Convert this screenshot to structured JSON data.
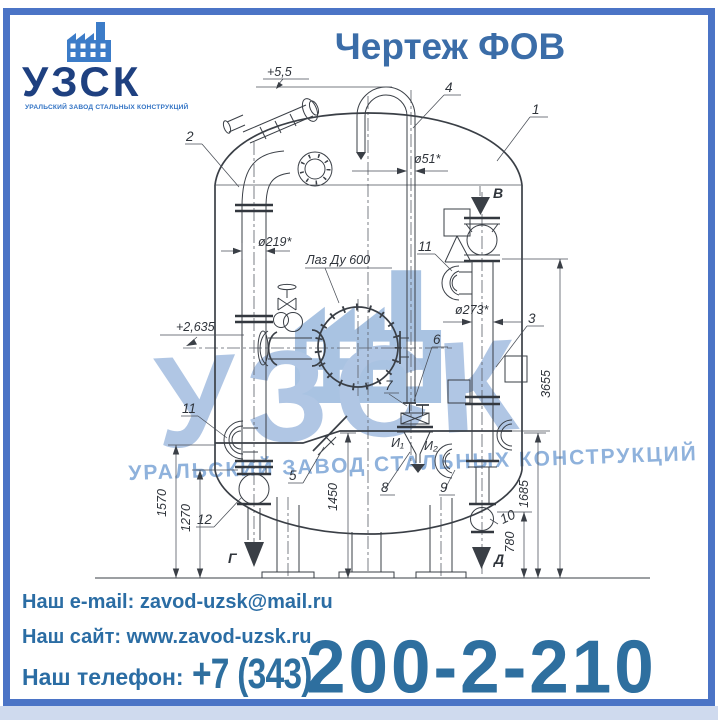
{
  "brand": {
    "name": "УЗСК",
    "tagline": "УРАЛЬСКИЙ ЗАВОД СТАЛЬНЫХ КОНСТРУКЦИЙ"
  },
  "title": "Чертеж ФОВ",
  "drawing": {
    "elevation_top": "+5,5",
    "elevation_mid": "+2,635",
    "manhole_label": "Лаз Ду 600",
    "dims": {
      "d51": "ø51*",
      "d219": "ø219*",
      "d273": "ø273*",
      "h3655": "3655",
      "h1685": "1685",
      "h1570": "1570",
      "h1270": "1270",
      "h1450": "1450",
      "h780": "780"
    },
    "callouts": {
      "c1": "1",
      "c2": "2",
      "c3": "3",
      "c4": "4",
      "c5": "5",
      "c6": "6",
      "c7": "7",
      "c8": "8",
      "c9": "9",
      "c10": "10",
      "c11": "11",
      "c12": "12"
    },
    "flows": {
      "v": "В",
      "g": "Г",
      "d": "Д",
      "i1": "И₁",
      "i2": "И₂"
    }
  },
  "watermark": {
    "name": "УЗСК",
    "tagline": "УРАЛЬСКИЙ ЗАВОД СТАЛЬНЫХ КОНСТРУКЦИЙ"
  },
  "footer": {
    "email_label": "Наш e-mail:",
    "email": "zavod-uzsk@mail.ru",
    "site_label": "Наш сайт:",
    "site": "www.zavod-uzsk.ru",
    "phone_label": "Наш телефон:",
    "phone_code": "+7 (343)",
    "phone_number": "200-2-210"
  },
  "colors": {
    "frame": "#4b74c6",
    "title": "#3b6da8",
    "contact": "#2b6da4",
    "logo_navy": "#1e4080",
    "logo_blue": "#3c7cc8",
    "watermark": "#b0c6e4"
  }
}
